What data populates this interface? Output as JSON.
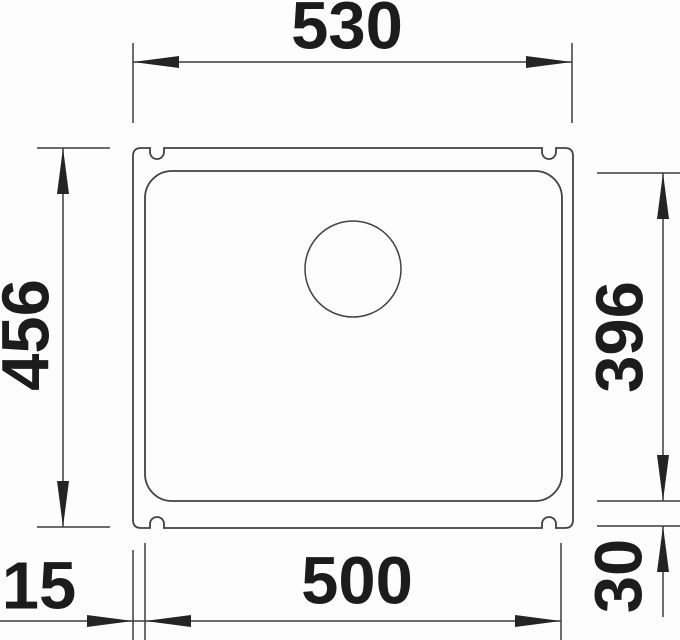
{
  "diagram": {
    "dimensions": {
      "overall_width": "530",
      "overall_depth": "456",
      "bowl_depth": "396",
      "bowl_width": "500",
      "rim_offset_side": "15",
      "rim_offset_bottom": "30"
    },
    "colors": {
      "line": "#424242",
      "text": "#1c1c1c",
      "background": "#fdfdfd"
    }
  }
}
